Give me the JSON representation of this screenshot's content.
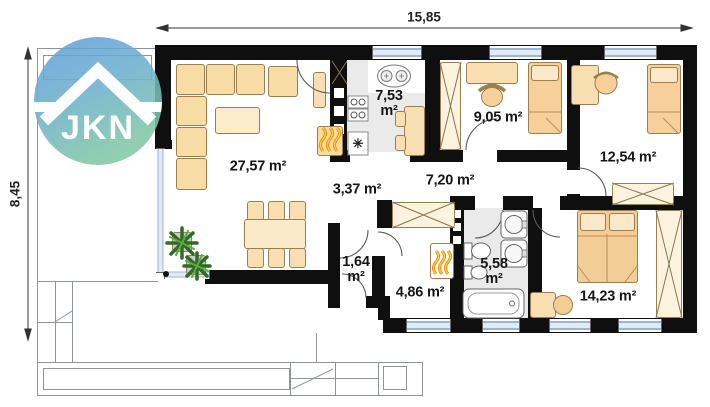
{
  "dimensions": {
    "width": "15,85",
    "height": "8,45"
  },
  "logo": {
    "text": "JKN",
    "gradient_top": "#64a0d9",
    "gradient_bottom": "#8bce9d"
  },
  "rooms": [
    {
      "name": "living-room",
      "area_label": "27,57 m²"
    },
    {
      "name": "kitchen",
      "area_label": "7,53\nm²"
    },
    {
      "name": "bedroom-1",
      "area_label": "9,05 m²"
    },
    {
      "name": "bedroom-2",
      "area_label": "12,54 m²"
    },
    {
      "name": "hall",
      "area_label": "3,37 m²"
    },
    {
      "name": "corridor",
      "area_label": "7,20 m²"
    },
    {
      "name": "entry",
      "area_label": "1,64\nm²"
    },
    {
      "name": "utility-room",
      "area_label": "4,86 m²"
    },
    {
      "name": "bathroom",
      "area_label": "5,58\nm²"
    },
    {
      "name": "bedroom-3",
      "area_label": "14,23 m²"
    }
  ],
  "icons": {
    "radiator": "✳"
  },
  "colors": {
    "wall": "#0f0f0f",
    "furniture": "#f8deb0",
    "window_glass": "#c7d7e8",
    "floor_gray": "#eaeaea",
    "flame": "#f49a0f"
  }
}
